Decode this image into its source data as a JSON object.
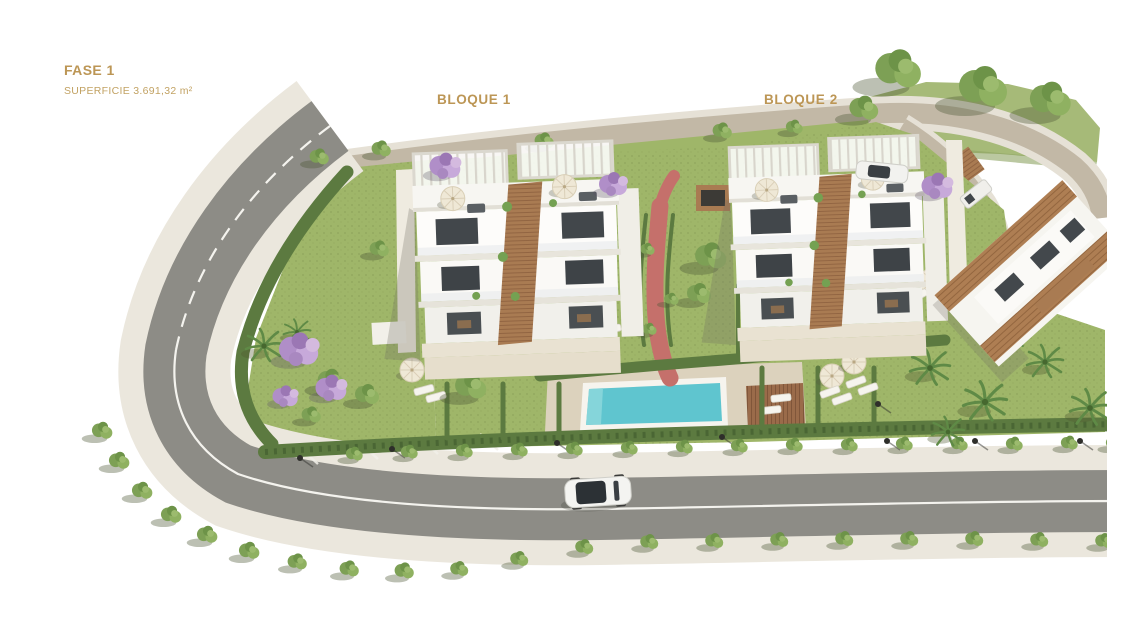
{
  "page": {
    "background": "#FFFFFF"
  },
  "labels": {
    "fase": "FASE 1",
    "superficie": "SUPERFICIE 3.691,32 m²",
    "bloque1": "BLOQUE 1",
    "bloque2": "BLOQUE 2"
  },
  "theme": {
    "accent_gold": "#BC9655",
    "accent_gold_light": "#C2A263",
    "lawn_green": "#9FB669",
    "hill_green": "#A6BA78",
    "hedge_green": "#5C7A40",
    "road_gray": "#8D8C86",
    "sidewalk_beige": "#EBE7DD",
    "upper_road_tan": "#C2B8A6",
    "pool_turquoise": "#5FC5CF",
    "deck_beige": "#DCD2BD",
    "wood_brown": "#A97B52",
    "path_red": "#C5706B",
    "building_white": "#F8F7F3"
  },
  "scene": {
    "description": "Aerial 3D render of phase 1 of a residential development: two white apartment blocks (Bloque 1, Bloque 2) with roof pergolas, communal turquoise pool with wooden sun deck, lawns with palms and jacaranda trees, red pedestrian path, tree-lined perimeter road with a white car"
  }
}
